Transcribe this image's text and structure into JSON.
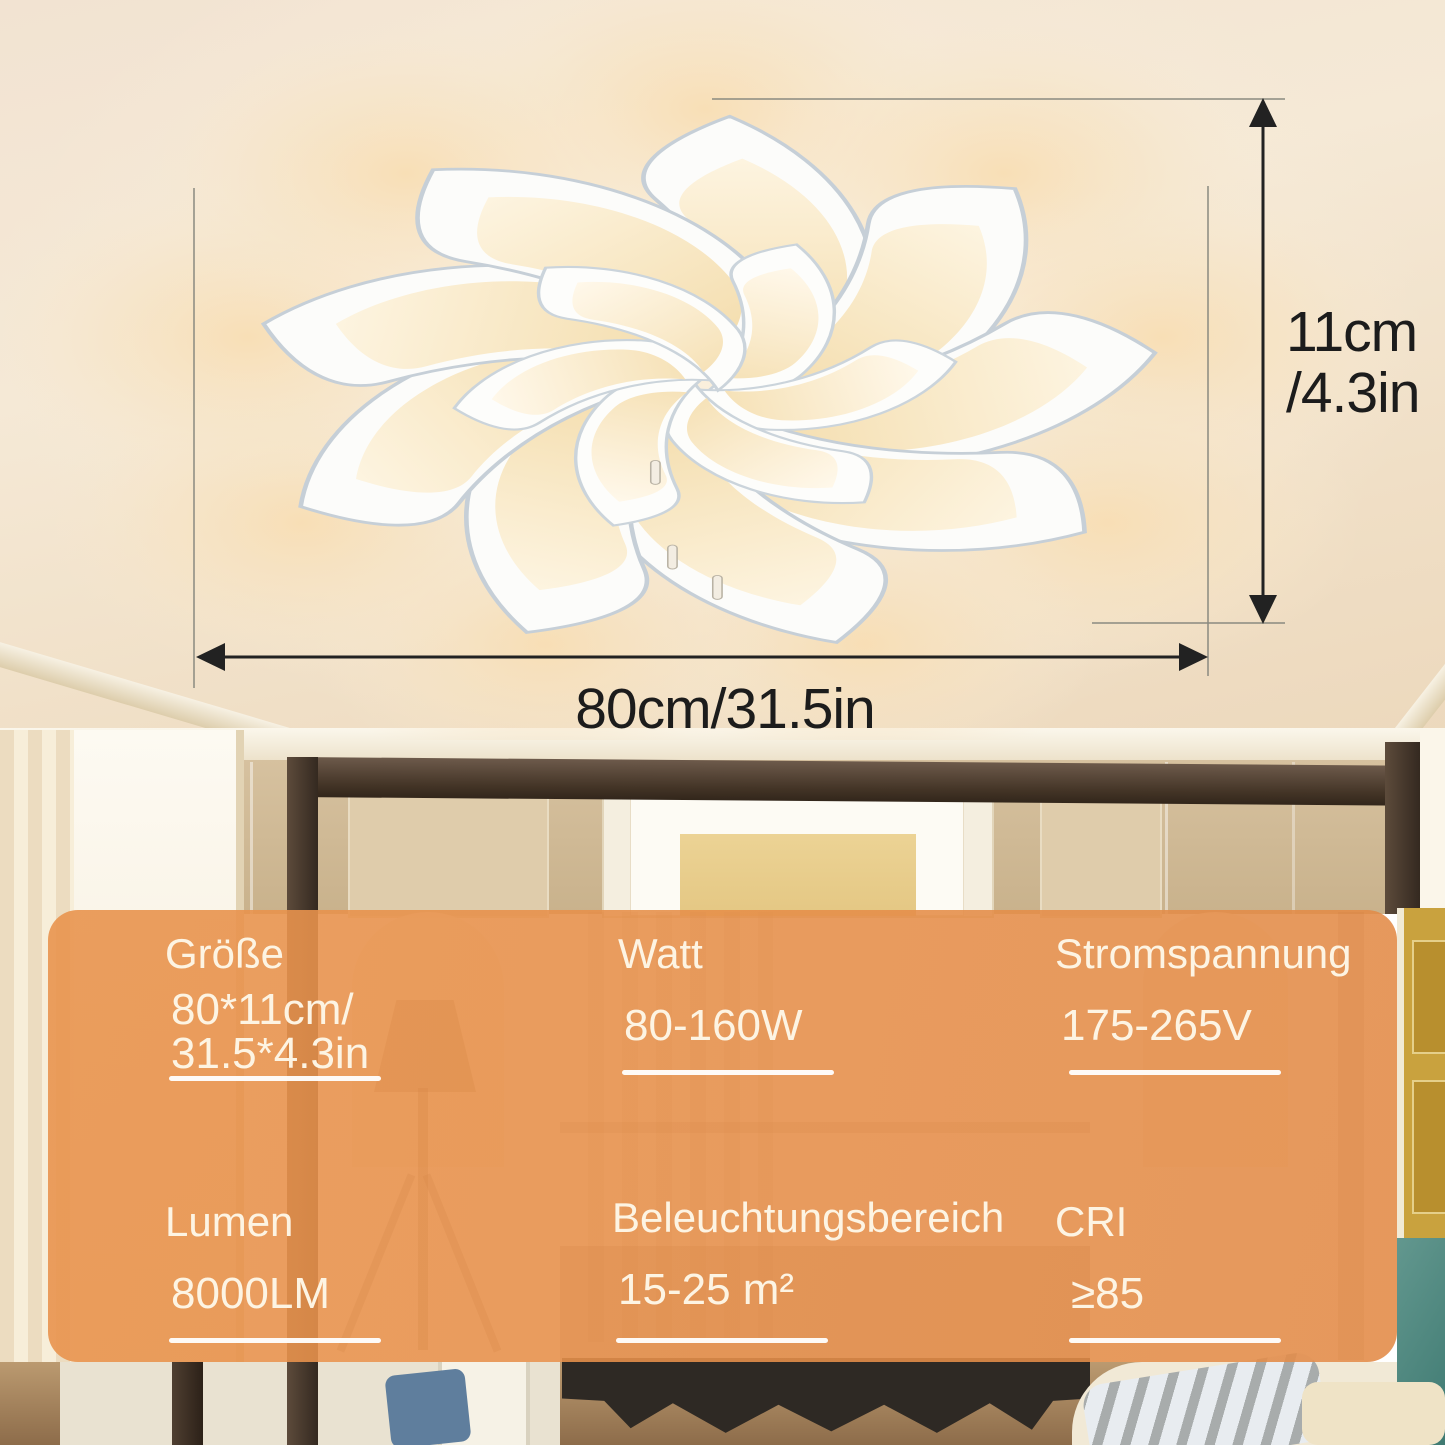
{
  "annotations": {
    "height_dim_line1": "11cm",
    "height_dim_line2": "/4.3in",
    "width_dim": "80cm/31.5in",
    "arrow_color": "#222222"
  },
  "spec_panel": {
    "accent_color": "#e6914d",
    "text_color": "#fdf4e3",
    "cells": [
      {
        "id": "groesse",
        "label": "Größe",
        "value": "80*11cm/",
        "value2": "31.5*4.3in"
      },
      {
        "id": "watt",
        "label": "Watt",
        "value": "80-160W"
      },
      {
        "id": "stromspannung",
        "label": "Stromspannung",
        "value": "175-265V"
      },
      {
        "id": "lumen",
        "label": "Lumen",
        "value": "8000LM"
      },
      {
        "id": "beleuchtungsbereich",
        "label": "Beleuchtungsbereich",
        "value": "15-25 m²"
      },
      {
        "id": "cri",
        "label": "CRI",
        "value": "≥85"
      }
    ]
  }
}
